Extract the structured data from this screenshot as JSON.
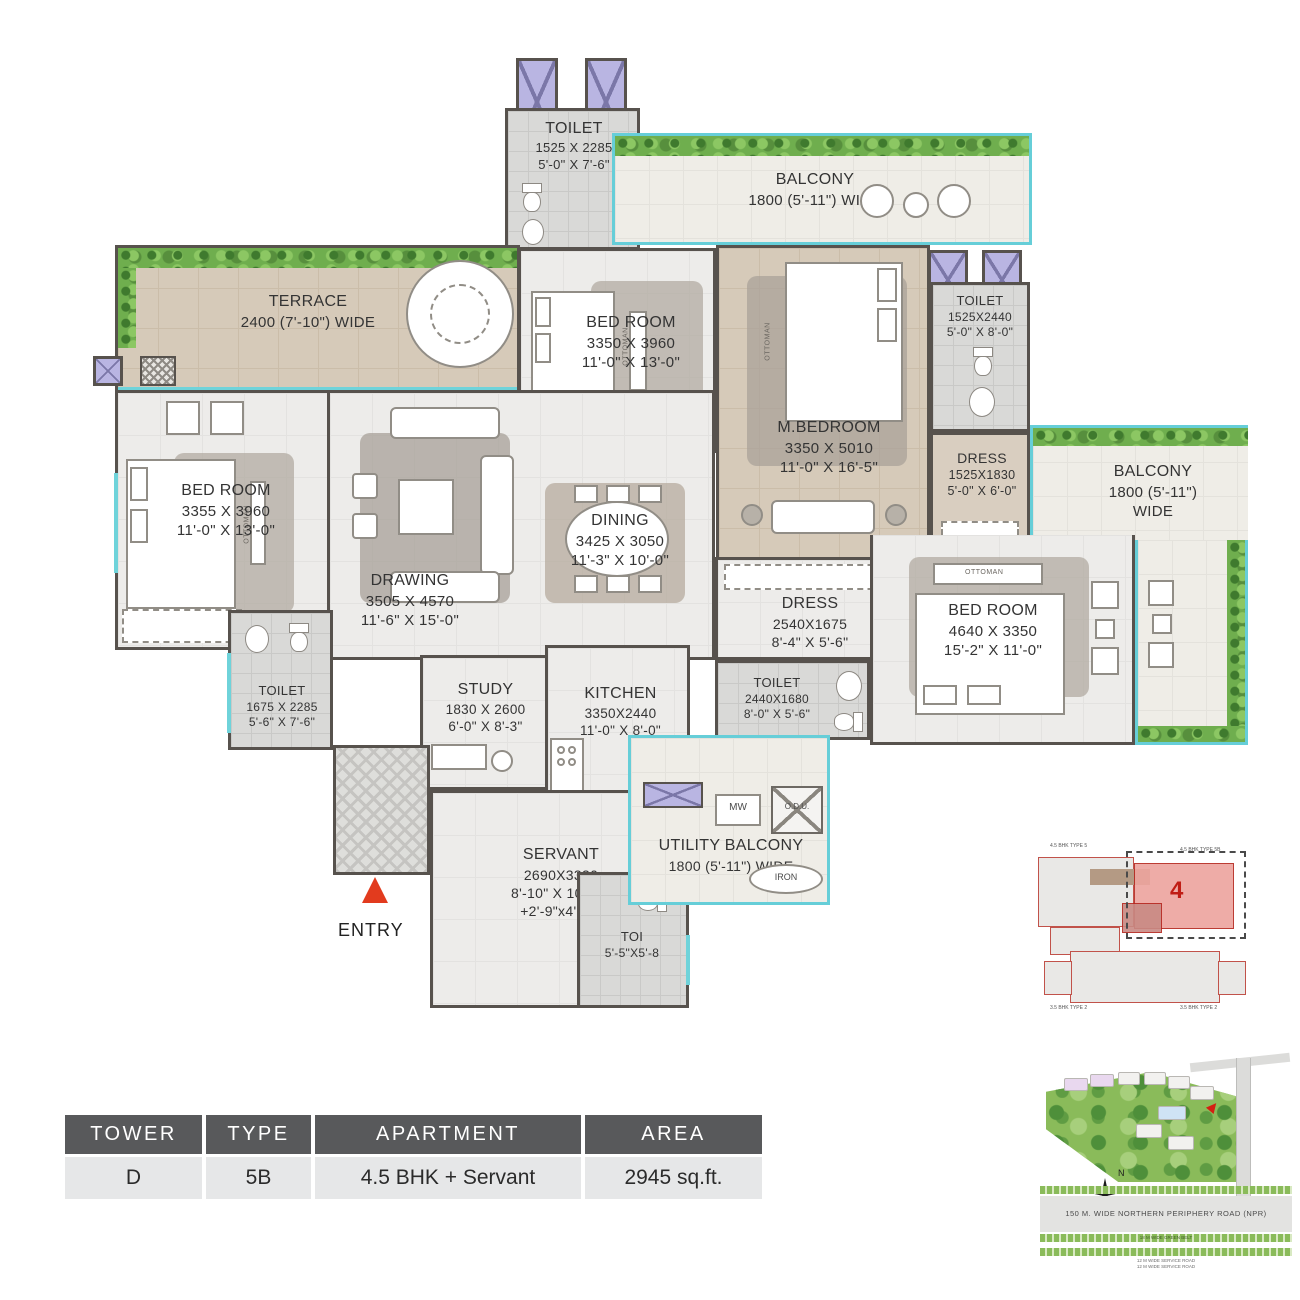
{
  "rooms": {
    "toilet_top": {
      "name": "TOILET",
      "mm": "1525 X 2285",
      "ft": "5'-0\" X 7'-6\""
    },
    "balcony_top": {
      "name": "BALCONY",
      "size": "1800 (5'-11\") WIDE"
    },
    "toilet_mbed": {
      "name": "TOILET",
      "mm": "1525X2440",
      "ft": "5'-0\" X 8'-0\""
    },
    "terrace": {
      "name": "TERRACE",
      "size": "2400 (7'-10\") WIDE"
    },
    "bedroom_top": {
      "name": "BED ROOM",
      "mm": "3350 X 3960",
      "ft": "11'-0\" X 13'-0\""
    },
    "mbedroom": {
      "name": "M.BEDROOM",
      "mm": "3350 X 5010",
      "ft": "11'-0\" X 16'-5\""
    },
    "dress_mbed": {
      "name": "DRESS",
      "mm": "1525X1830",
      "ft": "5'-0\" X 6'-0\""
    },
    "balcony_right": {
      "name": "BALCONY",
      "size1": "1800 (5'-11\")",
      "size2": "WIDE"
    },
    "bedroom_left": {
      "name": "BED ROOM",
      "mm": "3355 X 3960",
      "ft": "11'-0\" X 13'-0\""
    },
    "drawing": {
      "name": "DRAWING",
      "mm": "3505 X 4570",
      "ft": "11'-6\" X 15'-0\""
    },
    "dining": {
      "name": "DINING",
      "mm": "3425 X 3050",
      "ft": "11'-3\" X 10'-0\""
    },
    "dress_center": {
      "name": "DRESS",
      "mm": "2540X1675",
      "ft": "8'-4\" X 5'-6\""
    },
    "bedroom_right": {
      "name": "BED ROOM",
      "mm": "4640 X 3350",
      "ft": "15'-2\" X 11'-0\""
    },
    "toilet_left": {
      "name": "TOILET",
      "mm": "1675 X 2285",
      "ft": "5'-6\" X 7'-6\""
    },
    "study": {
      "name": "STUDY",
      "mm": "1830 X 2600",
      "ft": "6'-0\" X 8'-3\""
    },
    "kitchen": {
      "name": "KITCHEN",
      "mm": "3350X2440",
      "ft": "11'-0\" X 8'-0\""
    },
    "toilet_center": {
      "name": "TOILET",
      "mm": "2440X1680",
      "ft": "8'-0\" X 5'-6\""
    },
    "servant": {
      "name": "SERVANT",
      "mm": "2690X3330",
      "ft": "8'-10\" X 10'-11\"",
      "extra": "+2'-9\"x4'-11\""
    },
    "utility": {
      "name": "UTILITY BALCONY",
      "size": "1800 (5'-11\") WIDE"
    },
    "toi": {
      "name": "TOI",
      "ft": "5'-5\"X5'-8"
    }
  },
  "labels": {
    "entry": "ENTRY",
    "mw": "MW",
    "odu": "O.D.U.",
    "iron": "IRON",
    "ottoman": "OTTOMAN"
  },
  "summary_table": {
    "headers": [
      "TOWER",
      "TYPE",
      "APARTMENT",
      "AREA"
    ],
    "row": [
      "D",
      "5B",
      "4.5 BHK + Servant",
      "2945 sq.ft."
    ]
  },
  "key_plan": {
    "unit_number": "4",
    "labels": [
      "4.5 BHK TYPE 5",
      "4.5 BHK TYPE 5B",
      "3.5 BHK TYPE 2",
      "3.5 BHK TYPE 2"
    ]
  },
  "site_plan": {
    "npr_road": "150 M. WIDE NORTHERN PERIPHERY ROAD (NPR)",
    "green_belt": "18 M WIDE GREEN BELT",
    "service_road": "12 M WIDE SERVICE ROAD",
    "compass_n": "N"
  },
  "colors": {
    "wall": "#57524d",
    "teal_window": "#66ced8",
    "entry_red": "#e23b1e",
    "keyplan_red": "#c01d15",
    "master_floor_tan": "#d6cab9"
  }
}
